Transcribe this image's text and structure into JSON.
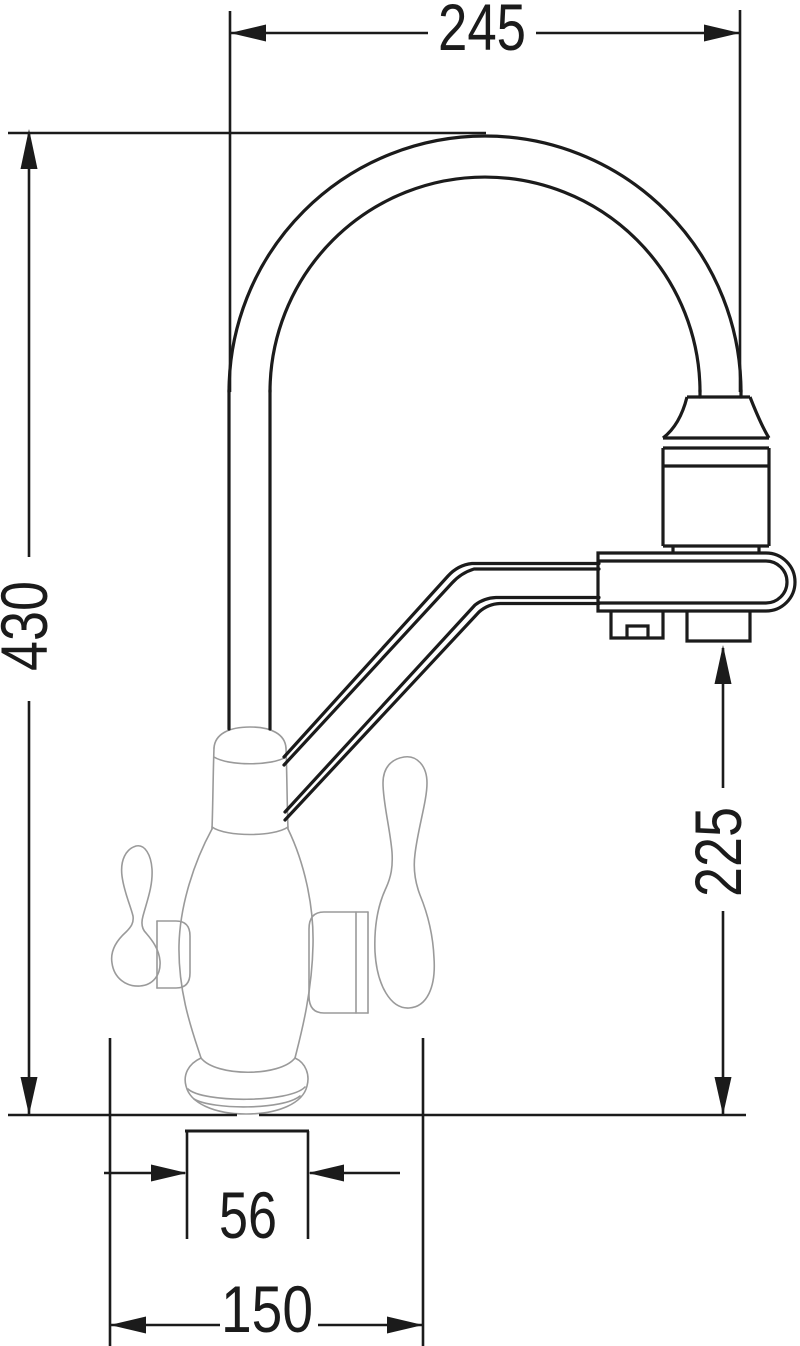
{
  "page": {
    "background": "#ffffff",
    "kind": "technical dimension drawing"
  },
  "drawing": {
    "subject": "three-way kitchen faucet with gooseneck spout and filter arm, front elevation",
    "stroke_color": "#1b1b1b",
    "body_stroke_color": "#9a9a9a",
    "dimensions": [
      {
        "id": "overall-width",
        "label": "245",
        "orientation": "horizontal",
        "position": "top"
      },
      {
        "id": "overall-height",
        "label": "430",
        "orientation": "vertical",
        "position": "left"
      },
      {
        "id": "outlet-height",
        "label": "225",
        "orientation": "vertical",
        "position": "right"
      },
      {
        "id": "base-neck-width",
        "label": "56",
        "orientation": "horizontal",
        "position": "bottom"
      },
      {
        "id": "base-footprint-width",
        "label": "150",
        "orientation": "horizontal",
        "position": "bottom"
      }
    ]
  }
}
